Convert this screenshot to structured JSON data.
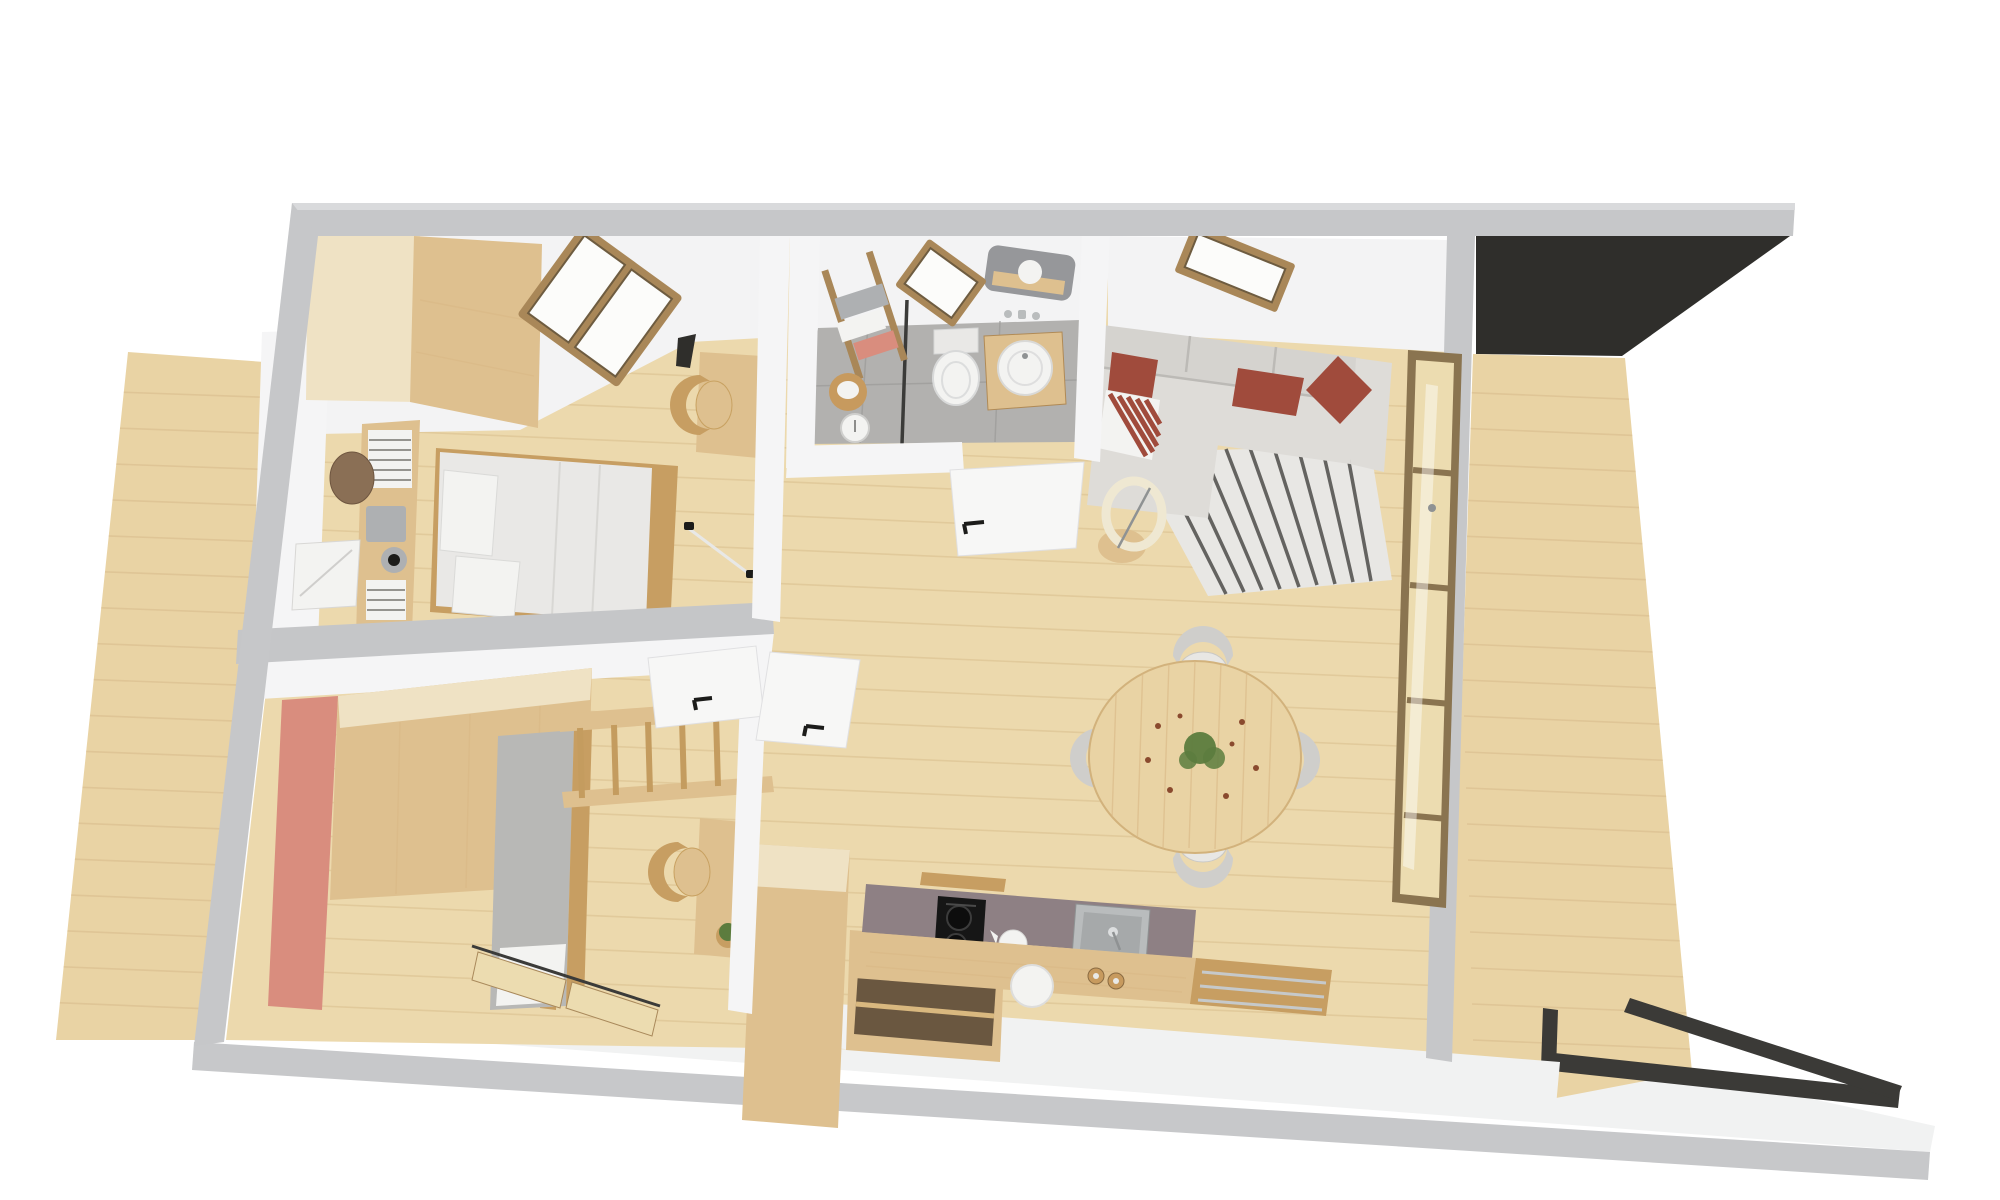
{
  "meta": {
    "kind": "3d-floor-plan-top-view-render",
    "text_visible": false
  },
  "colors": {
    "background": "#ffffff",
    "outerWall": "#c6c7c9",
    "outerWallLight": "#d9dadc",
    "innerWall": "#f5f5f6",
    "ceiling": "#f3f3f4",
    "dividerGrey": "#c5c6c8",
    "woodFloor": "#ecd9ad",
    "deckWood": "#e9d3a4",
    "platformWhite": "#f1f2f2",
    "slabEdge": "#c7c8ca",
    "darkTerrace": "#2f2e2b",
    "railingDark": "#3b3a37",
    "tileFloor": "#b2b1af",
    "partitionDark": "#3b3b39",
    "pinkWall": "#d98d7e",
    "paleWood": "#efe2c4",
    "furnWood": "#dec08f",
    "furnWoodDark": "#c79e62",
    "frameWood": "#a98758",
    "glassPane": "#fcfcfa",
    "glassTint": "#ecdcb0",
    "windowFrame": "#8a7450",
    "bedding": "#e9e8e6",
    "pillowWhite": "#f3f3f1",
    "greyFabric": "#b8b8b6",
    "sofaFabric": "#dedcd8",
    "sofaBack": "#d5d3cf",
    "pillowRed": "#a04b3c",
    "rugWhite": "#e8e7e4",
    "rugStripe": "#4c4b49",
    "counterMauve": "#8e8084",
    "cooktopBlack": "#161616",
    "steel": "#b9bcbd",
    "steelDark": "#8f9293",
    "basketTan": "#c79a5e",
    "hatBrown": "#8a6f55",
    "boxGrey": "#aeb0b2",
    "mirrorGrey": "#96979a",
    "plantGreen": "#5c7c3e",
    "plantRust": "#8a4a2e",
    "doorWhite": "#f7f7f6",
    "handleBlack": "#1c1c1a"
  },
  "scene": {
    "rooms": [
      {
        "id": "master-bedroom",
        "items": [
          "wardrobe",
          "bookshelf-column",
          "double-bed",
          "skylight-pair",
          "desk",
          "chair",
          "cone-lamp",
          "floor-lamp"
        ]
      },
      {
        "id": "bathroom",
        "items": [
          "skylight",
          "ladder-towel-rack",
          "towel-basket",
          "scale",
          "toilet",
          "shower-partition",
          "mirror",
          "vanity-basin"
        ]
      },
      {
        "id": "living-dining",
        "items": [
          "corner-sofa",
          "red-pillows",
          "striped-pillow",
          "striped-rug",
          "ring-lamp",
          "side-stool",
          "skylight",
          "round-dining-table",
          "table-plant",
          "four-chairs",
          "window-wall"
        ]
      },
      {
        "id": "kids-room",
        "items": [
          "pink-accent-wall",
          "wardrobe-block",
          "loft-bed",
          "guard-rail",
          "desk",
          "chair",
          "potted-plant",
          "sliding-glass-doors"
        ]
      },
      {
        "id": "kitchen",
        "items": [
          "tall-cabinet",
          "open-shelf-cube",
          "mauve-worktop",
          "induction-cooktop",
          "kettle",
          "steel-sink",
          "wood-drawer-front",
          "stool",
          "grinders"
        ]
      }
    ],
    "exterior": [
      "left-wood-deck",
      "right-wood-deck",
      "dark-roof-terrace",
      "white-walkway",
      "dark-railing"
    ]
  }
}
